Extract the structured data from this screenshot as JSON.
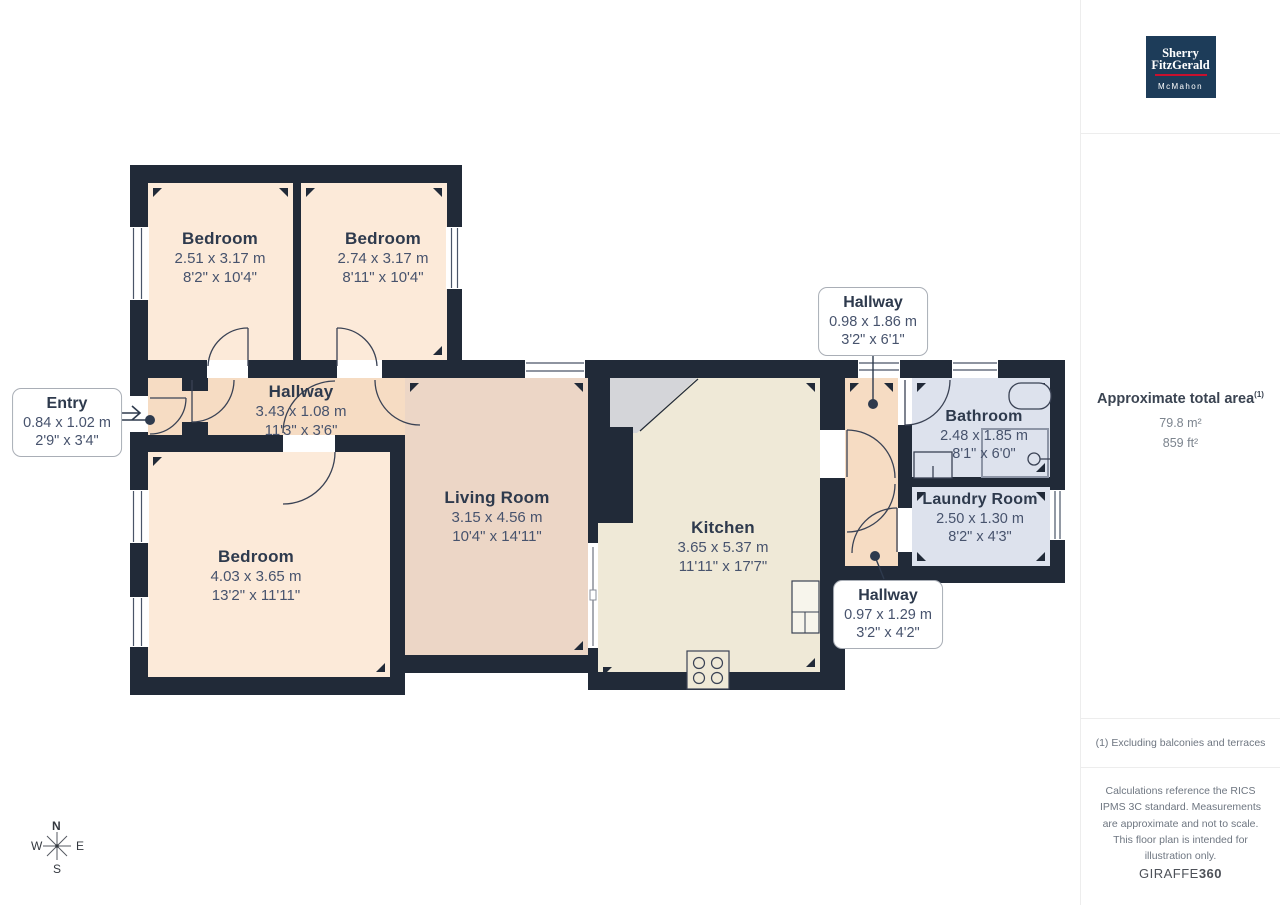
{
  "branding": {
    "name_top": "Sherry",
    "name_bottom": "FitzGerald",
    "sub": "McMahon",
    "navy": "#1d3c59",
    "red": "#c8102e"
  },
  "sidebar": {
    "area_title": "Approximate total area",
    "area_footnote_marker": "(1)",
    "area_metric": "79.8 m²",
    "area_imperial": "859 ft²",
    "footnote": "(1) Excluding balconies and terraces",
    "disclaimer": "Calculations reference the RICS IPMS 3C standard. Measurements are approximate and not to scale. This floor plan is intended for illustration only.",
    "brand_word": "GIRAFFE",
    "brand_number": "360"
  },
  "compass": {
    "north": "N",
    "east": "E",
    "south": "S",
    "west": "W"
  },
  "rooms": [
    {
      "id": "bedroom-top-left",
      "name": "Bedroom",
      "metric": "2.51 x 3.17 m",
      "imperial": "8'2\" x 10'4\""
    },
    {
      "id": "bedroom-top-right",
      "name": "Bedroom",
      "metric": "2.74 x 3.17 m",
      "imperial": "8'11\" x 10'4\""
    },
    {
      "id": "hallway-main",
      "name": "Hallway",
      "metric": "3.43 x 1.08 m",
      "imperial": "11'3\" x 3'6\""
    },
    {
      "id": "bedroom-left",
      "name": "Bedroom",
      "metric": "4.03 x 3.65 m",
      "imperial": "13'2\" x 11'11\""
    },
    {
      "id": "living-room",
      "name": "Living Room",
      "metric": "3.15 x 4.56 m",
      "imperial": "10'4\" x 14'11\""
    },
    {
      "id": "kitchen",
      "name": "Kitchen",
      "metric": "3.65 x 5.37 m",
      "imperial": "11'11\" x 17'7\""
    },
    {
      "id": "bathroom",
      "name": "Bathroom",
      "metric": "2.48 x 1.85 m",
      "imperial": "8'1\" x 6'0\""
    },
    {
      "id": "laundry-room",
      "name": "Laundry Room",
      "metric": "2.50 x 1.30 m",
      "imperial": "8'2\" x 4'3\""
    }
  ],
  "callouts": [
    {
      "id": "entry",
      "name": "Entry",
      "metric": "0.84 x 1.02 m",
      "imperial": "2'9\" x 3'4\""
    },
    {
      "id": "hallway-upper",
      "name": "Hallway",
      "metric": "0.98 x 1.86 m",
      "imperial": "3'2\" x 6'1\""
    },
    {
      "id": "hallway-lower",
      "name": "Hallway",
      "metric": "0.97 x 1.29 m",
      "imperial": "3'2\" x 4'2\""
    }
  ],
  "colors": {
    "wall": "#212a38",
    "bedroom_fill": "#fcead9",
    "hallway_fill": "#f6dcc3",
    "living_fill": "#ecd6c6",
    "kitchen_fill": "#efe9d7",
    "bath_fill": "#dde2ed",
    "gray_corner": "#d4d5d9"
  }
}
